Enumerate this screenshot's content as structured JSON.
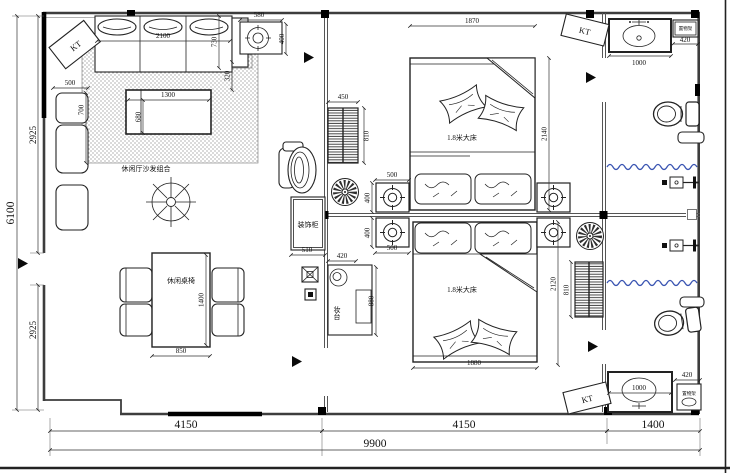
{
  "drawing": {
    "room_labels": {
      "sofa_area": "休闲厅沙发组合",
      "dining_set": "休闲桌椅",
      "bed1": "1.8米大床",
      "bed2": "1.8米大床",
      "deco_cabinet": "装饰柜",
      "dresser": "妆台",
      "shelf_top": "置物架",
      "shelf_bottom": "置物架"
    },
    "equipment_labels": {
      "kt_top_left": "KT",
      "kt_top_right": "KT",
      "kt_bottom_right": "KT"
    },
    "dimensions": {
      "overall": {
        "bottom_total": "9900",
        "bottom_left": "4150",
        "bottom_mid": "4150",
        "bottom_right": "1400",
        "left_total": "6100",
        "left_upper": "2925",
        "left_lower": "2925"
      },
      "living": {
        "sofa_width": "2100",
        "sofa_depth": "730",
        "sofa_gap": "320",
        "armchair_width": "500",
        "armchair_depth": "700",
        "table_width": "1300",
        "table_depth": "680",
        "side_unit_width": "580",
        "side_unit_depth": "400",
        "dining_width": "850",
        "dining_length": "1400",
        "deco_cabinet_width": "510"
      },
      "bedroom1": {
        "bed_width": "1870",
        "bed_length": "2140",
        "cabinet_width": "450",
        "cabinet_length": "810",
        "unit_width": "500",
        "unit_depth": "400"
      },
      "bedroom2": {
        "bed_width": "1880",
        "bed_length": "2120",
        "cabinet_length": "810",
        "unit_width": "500",
        "unit_depth": "400",
        "dresser_width": "420",
        "dresser_length": "880"
      },
      "bathroom": {
        "sink_top": "1000",
        "shelf_top_width": "420",
        "sink_bottom": "1000",
        "shelf_bottom_width": "420"
      }
    }
  }
}
